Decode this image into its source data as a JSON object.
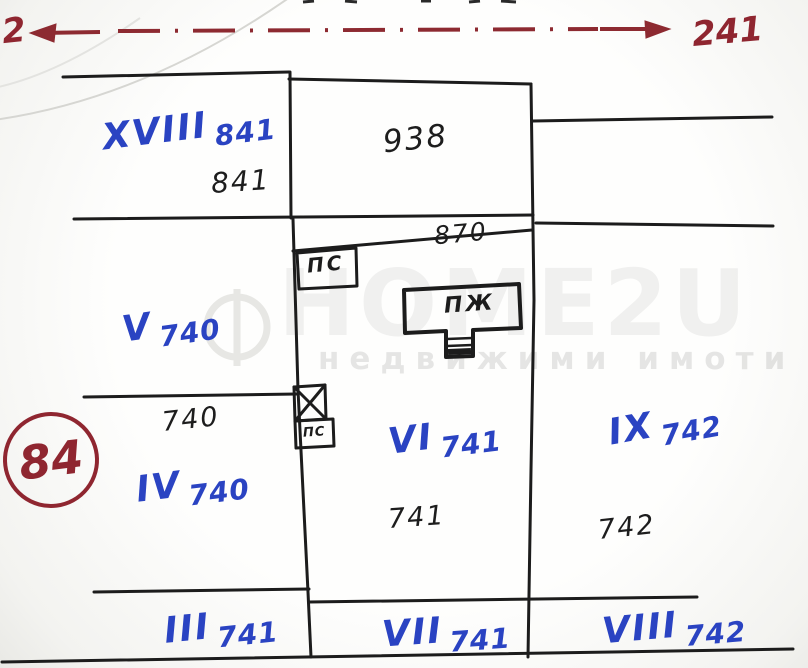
{
  "road": {
    "left_endpoint_label": "2",
    "right_endpoint_label": "241"
  },
  "stamp": {
    "number": "84"
  },
  "parcels": [
    {
      "roman": "XVIII",
      "plan_no": "841",
      "area_no": "841"
    },
    {
      "roman": "",
      "plan_no": "",
      "area_no": "938"
    },
    {
      "roman": "V",
      "plan_no": "740",
      "area_no": ""
    },
    {
      "roman": "IV",
      "plan_no": "740",
      "area_no": "740"
    },
    {
      "roman": "VI",
      "plan_no": "741",
      "area_no": "741"
    },
    {
      "roman": "IX",
      "plan_no": "742",
      "area_no": "742"
    },
    {
      "roman": "III",
      "plan_no": "741",
      "area_no": ""
    },
    {
      "roman": "VII",
      "plan_no": "741",
      "area_no": ""
    },
    {
      "roman": "VIII",
      "plan_no": "742",
      "area_no": ""
    }
  ],
  "annotations": {
    "strip_measure": "870",
    "outbuilding_label": "ПС",
    "outbuilding_small_label": "ПС",
    "building_label": "ПЖ"
  },
  "watermark": {
    "logo_text": "HOME2U",
    "tagline": "недвижими имоти"
  },
  "colors": {
    "ink_black": "#1c1c1c",
    "ink_blue": "#2a43c2",
    "ink_red": "#8f2630",
    "watermark_gray": "#e4e4e4"
  }
}
